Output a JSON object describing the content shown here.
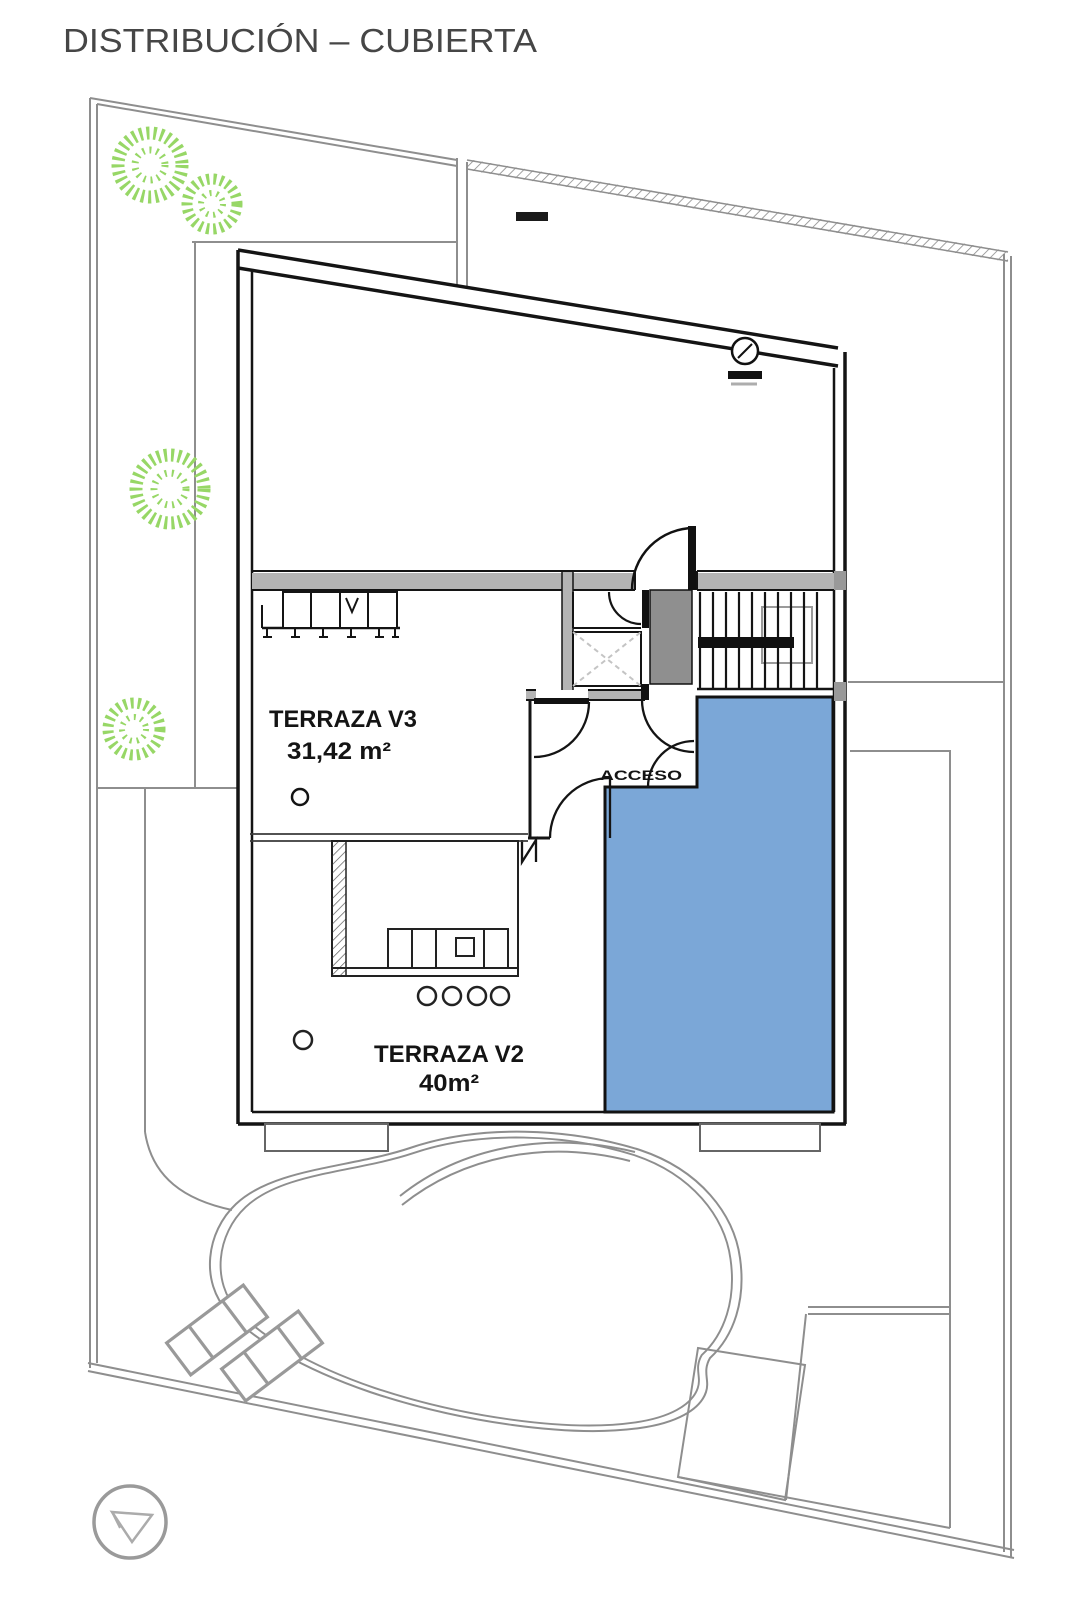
{
  "title": "DISTRIBUCIÓN – CUBIERTA",
  "plan": {
    "rooms": [
      {
        "id": "terraza-v3",
        "label": "TERRAZA V3",
        "area": "31,42 m²"
      },
      {
        "id": "terraza-v2",
        "label": "TERRAZA V2",
        "area": "40m²"
      }
    ],
    "annotations": [
      {
        "id": "acceso",
        "label": "ACCESO"
      }
    ],
    "icons": [
      "tree-icon",
      "pool",
      "sun-lounger-icon",
      "north-arrow-icon",
      "roof-vent-icon",
      "stairs",
      "elevator",
      "door-arc"
    ],
    "colors": {
      "pool_fill": "#7BA7D7",
      "tree_green": "#97D766",
      "wall_fill": "#8F8F8F",
      "band_fill": "#B4B4B4",
      "site_line": "#8E8E8E",
      "ink": "#161616"
    }
  }
}
